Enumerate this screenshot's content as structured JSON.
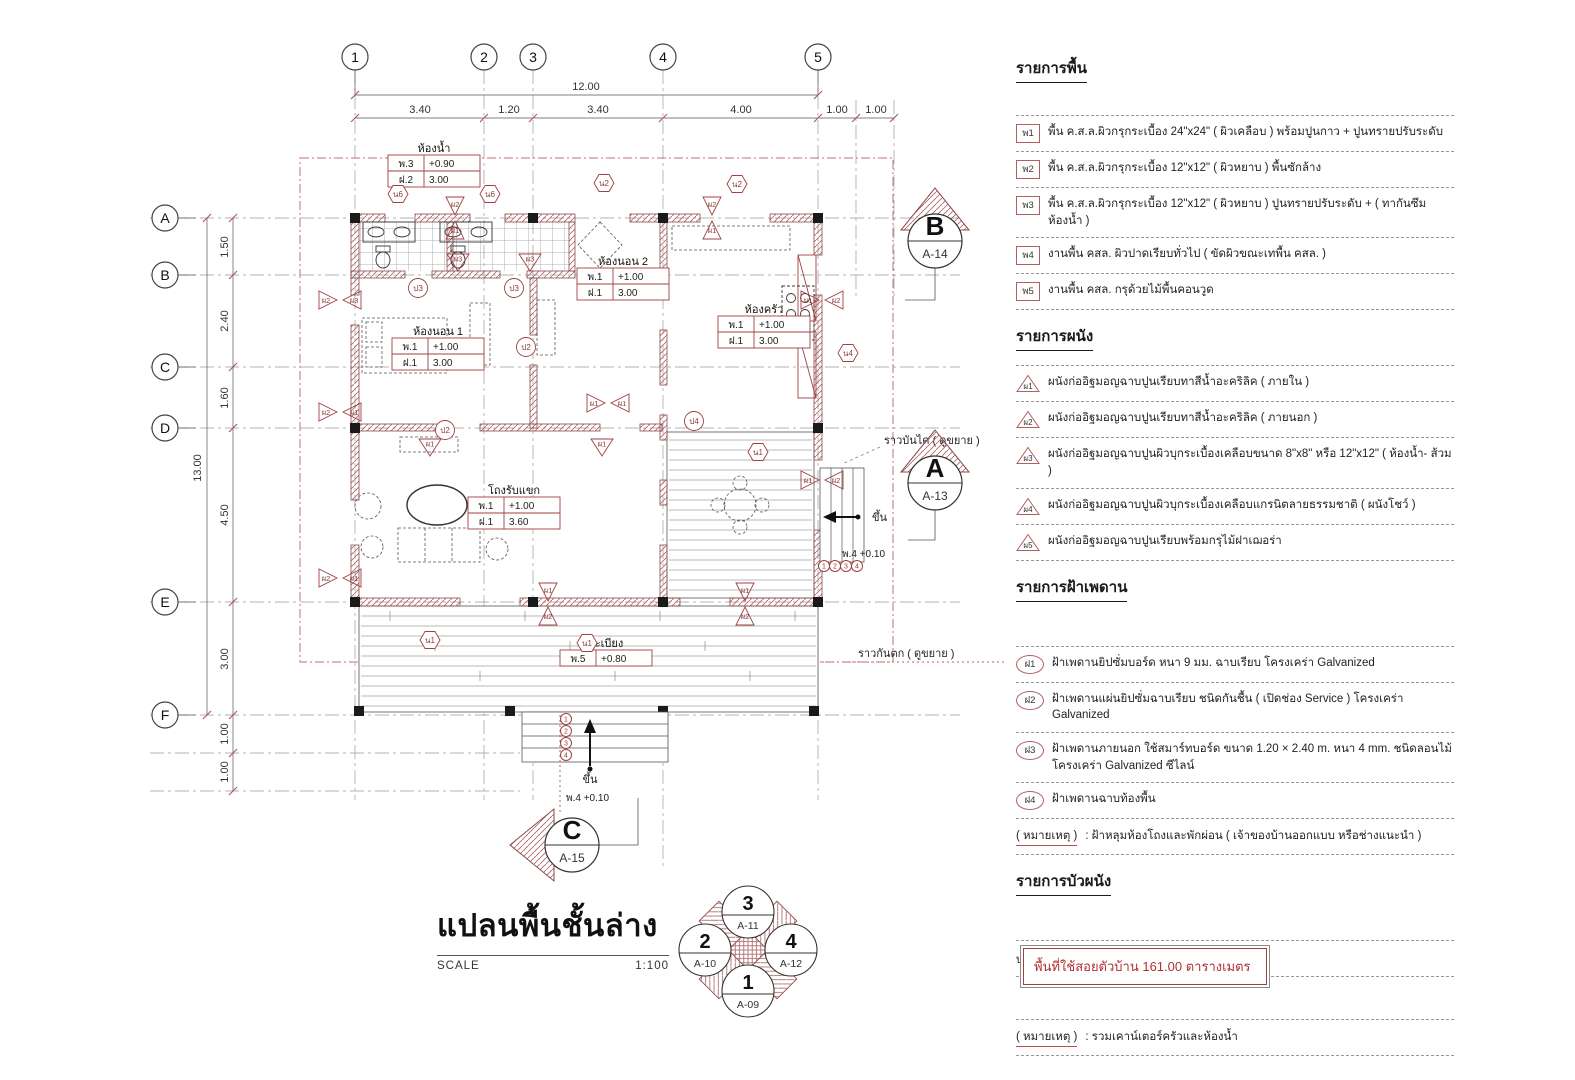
{
  "title": {
    "name": "แปลนพื้นชั้นล่าง",
    "scale_label": "SCALE",
    "scale_value": "1:100"
  },
  "area_box": {
    "text": "พื้นที่ใช้สอยตัวบ้าน  161.00 ตารางเมตร"
  },
  "colors": {
    "red_line": "#a04040",
    "red_text": "#b03030",
    "hatch": "#b06a6a",
    "black": "#222222"
  },
  "lists": {
    "floor": {
      "heading": "รายการพื้น",
      "items": [
        {
          "tag": "พ1",
          "text": "พื้น ค.ส.ล.ผิวกรุกระเบื้อง 24\"x24\"  ( ผิวเคลือบ ) พร้อมปูนกาว + ปูนทรายปรับระดับ"
        },
        {
          "tag": "พ2",
          "text": "พื้น ค.ส.ล.ผิวกรุกระเบื้อง 12\"x12\"  ( ผิวหยาบ )  พื้นซักล้าง"
        },
        {
          "tag": "พ3",
          "text": "พื้น ค.ส.ล.ผิวกรุกระเบื้อง 12\"x12\"  ( ผิวหยาบ )  ปูนทรายปรับระดับ + ( ทากันซึมห้องน้ำ )"
        },
        {
          "tag": "พ4",
          "text": "งานพื้น คสล. ผิวปาดเรียบทั่วไป  ( ขัดผิวขณะเทพื้น คสล. )"
        },
        {
          "tag": "พ5",
          "text": "งานพื้น คสล. กรุด้วยไม้พื้นคอนวูด"
        }
      ]
    },
    "wall": {
      "heading": "รายการผนัง",
      "items": [
        {
          "tag": "ผ1",
          "text": "ผนังก่ออิฐมอญฉาบปูนเรียบทาสีน้ำอะคริลิค   ( ภายใน )"
        },
        {
          "tag": "ผ2",
          "text": "ผนังก่ออิฐมอญฉาบปูนเรียบทาสีน้ำอะคริลิค   ( ภายนอก )"
        },
        {
          "tag": "ผ3",
          "text": "ผนังก่ออิฐมอญฉาบปูนผิวบุกระเบื้องเคลือบขนาด 8\"x8\" หรือ 12\"x12\"  ( ห้องน้ำ- ส้วม )"
        },
        {
          "tag": "ผ4",
          "text": "ผนังก่ออิฐมอญฉาบปูนผิวบุกระเบื้องเคลือบแกรนิตลายธรรมชาติ ( ผนังโชว์ )"
        },
        {
          "tag": "ผ5",
          "text": "ผนังก่ออิฐมอญฉาบปูนเรียบพร้อมกรุไม้ฝาเฌอร่า"
        }
      ]
    },
    "ceiling": {
      "heading": "รายการฝ้าเพดาน",
      "items": [
        {
          "tag": "ฝ1",
          "text": "ฝ้าเพดานยิปซั่มบอร์ด หนา 9 มม. ฉาบเรียบ  โครงเคร่า Galvanized"
        },
        {
          "tag": "ฝ2",
          "text": "ฝ้าเพดานแผ่นยิปซั่มฉาบเรียบ ชนิดกันชื้น ( เปิดช่อง Service ) โครงเคร่า Galvanized"
        },
        {
          "tag": "ฝ3",
          "text": "ฝ้าเพดานภายนอก ใช้สมาร์ทบอร์ด ขนาด 1.20 × 2.40 m. หนา 4 mm. ชนิดลอนไม้ โครงเคร่า Galvanized ซีไลน์"
        },
        {
          "tag": "ฝ4",
          "text": "ฝ้าเพดานฉาบท้องพื้น"
        }
      ],
      "note_label": "( หมายเหตุ )",
      "note_text": " : ฝ้าหลุมห้องโถงและพักผ่อน ( เจ้าของบ้านออกแบบ หรือช่างแนะนำ )"
    },
    "molding": {
      "heading": "รายการบัวผนัง",
      "items": [
        {
          "tag": "บ.1",
          "text": "บัวพื้น 4\" ( บัวเทียม PVC สำเร็จรูป )"
        }
      ],
      "note_label": "( หมายเหตุ )",
      "note_text": " : รวมเคาน์เตอร์ครัวและห้องน้ำ"
    }
  },
  "plan": {
    "grid_cols": [
      [
        "1",
        355
      ],
      [
        "2",
        484
      ],
      [
        "3",
        533
      ],
      [
        "4",
        663
      ],
      [
        "5",
        818
      ]
    ],
    "grid_rows": [
      [
        "A",
        218
      ],
      [
        "B",
        275
      ],
      [
        "C",
        367
      ],
      [
        "D",
        428
      ],
      [
        "E",
        602
      ],
      [
        "F",
        715
      ]
    ],
    "top_total": "12.00",
    "top_dims": [
      [
        "3.40",
        420
      ],
      [
        "1.20",
        509
      ],
      [
        "3.40",
        598
      ],
      [
        "4.00",
        741
      ],
      [
        "1.00",
        837
      ],
      [
        "1.00",
        876
      ]
    ],
    "left_total": "13.00",
    "left_dims": [
      [
        "1.50",
        247
      ],
      [
        "2.40",
        321
      ],
      [
        "1.60",
        398
      ],
      [
        "4.50",
        515
      ],
      [
        "3.00",
        659
      ],
      [
        "1.00",
        734
      ],
      [
        "1.00",
        772
      ]
    ],
    "rooms": [
      {
        "label": "ห้องน้ำ",
        "x": 388,
        "y": 155,
        "rows": [
          [
            "พ.3",
            "+0.90"
          ],
          [
            "ฝ.2",
            "3.00"
          ]
        ]
      },
      {
        "label": "ห้องนอน 2",
        "x": 577,
        "y": 268,
        "rows": [
          [
            "พ.1",
            "+1.00"
          ],
          [
            "ฝ.1",
            "3.00"
          ]
        ]
      },
      {
        "label": "ห้องครัว",
        "x": 718,
        "y": 316,
        "rows": [
          [
            "พ.1",
            "+1.00"
          ],
          [
            "ฝ.1",
            "3.00"
          ]
        ]
      },
      {
        "label": "ห้องนอน 1",
        "x": 392,
        "y": 338,
        "rows": [
          [
            "พ.1",
            "+1.00"
          ],
          [
            "ฝ.1",
            "3.00"
          ]
        ]
      },
      {
        "label": "โถงรับแขก",
        "x": 468,
        "y": 497,
        "rows": [
          [
            "พ.1",
            "+1.00"
          ],
          [
            "ฝ.1",
            "3.60"
          ]
        ]
      },
      {
        "label": "ระเบียง",
        "x": 560,
        "y": 650,
        "rows": [
          [
            "พ.5",
            "+0.80"
          ]
        ]
      }
    ],
    "annotations": [
      {
        "text": "ราวบันได ( ดูขยาย )",
        "x": 884,
        "y": 444,
        "anchor": "start",
        "size": 11
      },
      {
        "text": "ราวกันตก ( ดูขยาย )",
        "x": 858,
        "y": 657,
        "anchor": "start",
        "size": 11
      },
      {
        "text": "ขึ้น",
        "x": 590,
        "y": 783,
        "anchor": "middle",
        "size": 11
      },
      {
        "text": "พ.4 +0.10",
        "x": 566,
        "y": 801,
        "anchor": "start",
        "size": 10
      },
      {
        "text": "ขึ้น",
        "x": 872,
        "y": 521,
        "anchor": "start",
        "size": 11
      },
      {
        "text": "พ.4 +0.10",
        "x": 842,
        "y": 557,
        "anchor": "start",
        "size": 10
      }
    ],
    "stair_steps": [
      "1",
      "2",
      "3",
      "4"
    ],
    "tags": [
      {
        "t": "bh",
        "x": 340,
        "y": 300,
        "l": [
          "ผ2",
          "ผ3"
        ]
      },
      {
        "t": "bh",
        "x": 340,
        "y": 412,
        "l": [
          "ผ2",
          "ผ1"
        ]
      },
      {
        "t": "bh",
        "x": 340,
        "y": 578,
        "l": [
          "ผ2",
          "ผ1"
        ]
      },
      {
        "t": "bh",
        "x": 822,
        "y": 300,
        "l": [
          "ผ1",
          "ผ2"
        ]
      },
      {
        "t": "bh",
        "x": 822,
        "y": 480,
        "l": [
          "ผ1",
          "ผ2"
        ]
      },
      {
        "t": "bh",
        "x": 608,
        "y": 403,
        "l": [
          "ผ1",
          "ผ1"
        ]
      },
      {
        "t": "bv",
        "x": 455,
        "y": 218,
        "l": [
          "ผ2",
          "ผ1"
        ]
      },
      {
        "t": "bv",
        "x": 712,
        "y": 218,
        "l": [
          "ผ2",
          "ผ1"
        ]
      },
      {
        "t": "bv",
        "x": 548,
        "y": 604,
        "l": [
          "ผ1",
          "ผ2"
        ]
      },
      {
        "t": "bv",
        "x": 745,
        "y": 604,
        "l": [
          "ผ1",
          "ผ2"
        ]
      },
      {
        "t": "s",
        "x": 430,
        "y": 447,
        "l": [
          "ผ1"
        ]
      },
      {
        "t": "s",
        "x": 602,
        "y": 447,
        "l": [
          "ผ1"
        ]
      },
      {
        "t": "s",
        "x": 458,
        "y": 262,
        "l": [
          "ผ3"
        ]
      },
      {
        "t": "s",
        "x": 530,
        "y": 262,
        "l": [
          "ผ3"
        ]
      },
      {
        "t": "hex",
        "x": 398,
        "y": 194,
        "l": [
          "น6"
        ]
      },
      {
        "t": "hex",
        "x": 490,
        "y": 194,
        "l": [
          "น6"
        ]
      },
      {
        "t": "hex",
        "x": 604,
        "y": 183,
        "l": [
          "น2"
        ]
      },
      {
        "t": "hex",
        "x": 737,
        "y": 184,
        "l": [
          "น2"
        ]
      },
      {
        "t": "hex",
        "x": 848,
        "y": 353,
        "l": [
          "น4"
        ]
      },
      {
        "t": "hex",
        "x": 430,
        "y": 640,
        "l": [
          "น1"
        ]
      },
      {
        "t": "hex",
        "x": 587,
        "y": 643,
        "l": [
          "น1"
        ]
      },
      {
        "t": "hex",
        "x": 758,
        "y": 452,
        "l": [
          "น1"
        ]
      },
      {
        "t": "c",
        "x": 418,
        "y": 288,
        "l": [
          "ป3"
        ]
      },
      {
        "t": "c",
        "x": 514,
        "y": 288,
        "l": [
          "ป3"
        ]
      },
      {
        "t": "c",
        "x": 526,
        "y": 347,
        "l": [
          "ป2"
        ]
      },
      {
        "t": "c",
        "x": 694,
        "y": 421,
        "l": [
          "ป4"
        ]
      },
      {
        "t": "c",
        "x": 445,
        "y": 430,
        "l": [
          "ป2"
        ]
      }
    ],
    "sections": [
      {
        "letter": "B",
        "sheet": "A-14",
        "x": 935,
        "y": 240,
        "dir": "up"
      },
      {
        "letter": "A",
        "sheet": "A-13",
        "x": 935,
        "y": 482,
        "dir": "up"
      },
      {
        "letter": "C",
        "sheet": "A-15",
        "x": 562,
        "y": 845,
        "dir": "left"
      }
    ],
    "keyplan": {
      "cx": 748,
      "cy": 950,
      "circles": [
        {
          "num": "3",
          "sheet": "A-11",
          "dx": 0,
          "dy": -38
        },
        {
          "num": "2",
          "sheet": "A-10",
          "dx": -43,
          "dy": 0
        },
        {
          "num": "4",
          "sheet": "A-12",
          "dx": 43,
          "dy": 0
        },
        {
          "num": "1",
          "sheet": "A-09",
          "dx": 0,
          "dy": 41
        }
      ]
    }
  }
}
